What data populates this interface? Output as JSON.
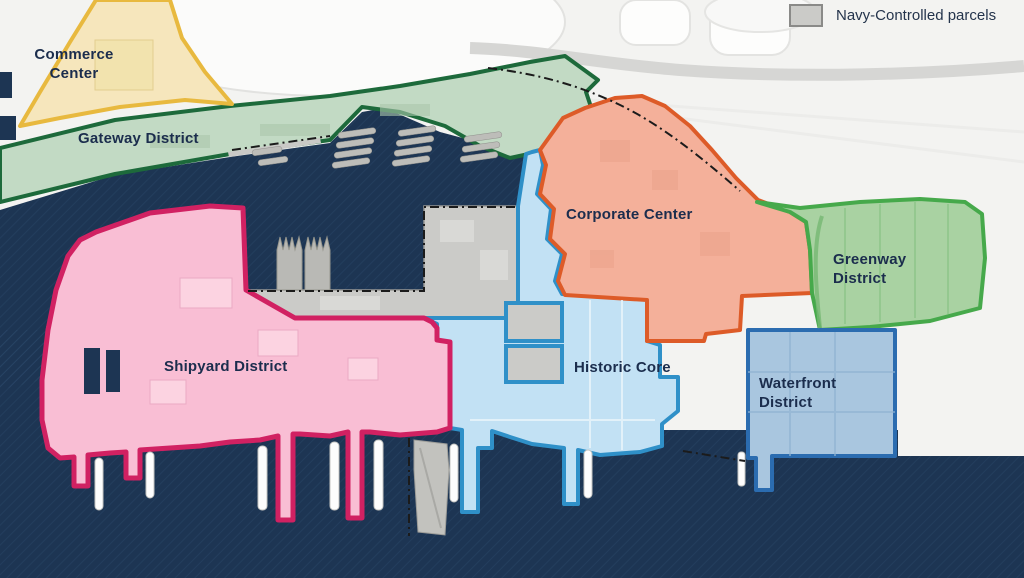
{
  "legend": {
    "label": "Navy-Controlled parcels"
  },
  "districts": [
    {
      "id": "commerce",
      "label": "Commerce Center",
      "fill": "#f6e6bc",
      "stroke": "#e8b93f"
    },
    {
      "id": "gateway",
      "label": "Gateway District",
      "fill": "#c2dac4",
      "stroke": "#1d6a3b"
    },
    {
      "id": "corporate",
      "label": "Corporate Center",
      "fill": "#f4b09a",
      "stroke": "#dd5b28"
    },
    {
      "id": "greenway",
      "label": "Greenway District",
      "fill": "#a9d2a2",
      "stroke": "#46a94b"
    },
    {
      "id": "shipyard",
      "label": "Shipyard District",
      "fill": "#f9bed4",
      "stroke": "#d12162"
    },
    {
      "id": "historic",
      "label": "Historic Core",
      "fill": "#c2e1f4",
      "stroke": "#2f90c8"
    },
    {
      "id": "waterfront",
      "label": "Waterfront District",
      "fill": "#a9c6df",
      "stroke": "#2b6cb0"
    }
  ],
  "colors": {
    "water": "#1d3553",
    "water_hatch": "#2e4d70",
    "land": "#f3f3f1",
    "parcel": "#cbcbc8",
    "parcel_border": "#979794",
    "boundary_dash": "#1b1b1b",
    "road": "#d6d6d4",
    "ship_gray": "#bdbdb9",
    "ship_white": "#fdfdfd",
    "label_text": "#1b2d4d",
    "legend_text": "#24344c"
  }
}
